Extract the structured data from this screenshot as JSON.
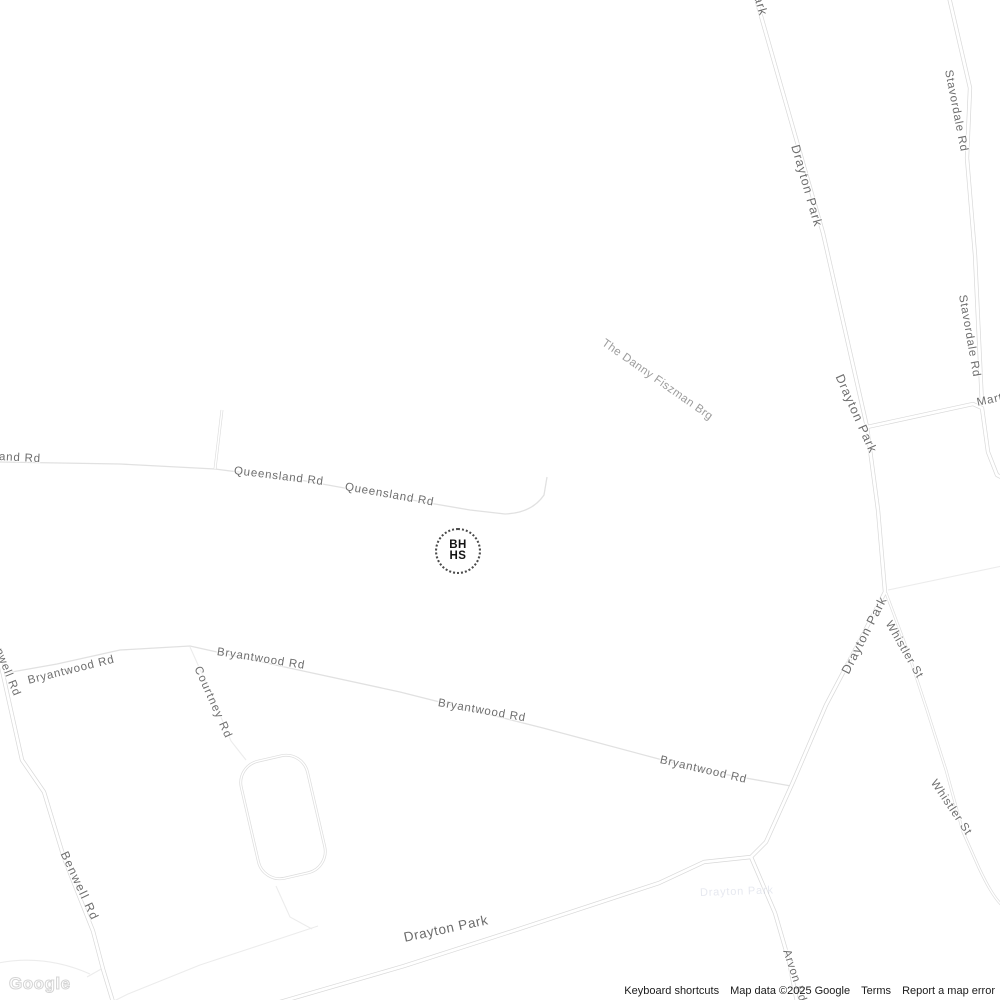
{
  "map": {
    "colors": {
      "background": "#ffffff",
      "road_casing": "#d8d8d8",
      "road_fill": "#ffffff",
      "minor_road": "#e1e1e1",
      "faint_path": "#ececec",
      "label": "#6e6e6e",
      "label_secondary": "#9c9c9c"
    },
    "labels": [
      {
        "name": "road-label-drayton-park-top",
        "text": "ark",
        "x": 758,
        "y": -4,
        "rot": 74,
        "cls": "lbl-main"
      },
      {
        "name": "road-label-drayton-park-1",
        "text": "Drayton Park",
        "x": 795,
        "y": 145,
        "rot": 74,
        "cls": "lbl-main"
      },
      {
        "name": "road-label-stavordale-rd-1",
        "text": "Stavordale Rd",
        "x": 948,
        "y": 70,
        "rot": 79
      },
      {
        "name": "road-label-stavordale-rd-2",
        "text": "Stavordale Rd",
        "x": 962,
        "y": 295,
        "rot": 80
      },
      {
        "name": "road-label-drayton-park-2",
        "text": "Drayton Park",
        "x": 839,
        "y": 375,
        "rot": 66,
        "cls": "lbl-main"
      },
      {
        "name": "road-label-martineau-rd",
        "text": "Martineau Rd",
        "x": 977,
        "y": 403,
        "rot": -12
      },
      {
        "name": "road-label-danny-fiszman-bridge",
        "text": "The Danny Fiszman Brg",
        "x": 603,
        "y": 342,
        "rot": 35,
        "cls": "lbl-bridge"
      },
      {
        "name": "road-label-queensland-rd-left",
        "text": "and Rd",
        "x": -1,
        "y": 457,
        "rot": 3
      },
      {
        "name": "road-label-queensland-rd-1",
        "text": "Queensland Rd",
        "x": 234,
        "y": 471,
        "rot": 7
      },
      {
        "name": "road-label-queensland-rd-2",
        "text": "Queensland Rd",
        "x": 345,
        "y": 487,
        "rot": 10
      },
      {
        "name": "road-label-benwell-rd-top",
        "text": "nwell Rd",
        "x": -2,
        "y": 649,
        "rot": 68
      },
      {
        "name": "road-label-bryantwood-rd-1",
        "text": "Bryantwood Rd",
        "x": 28,
        "y": 681,
        "rot": -14
      },
      {
        "name": "road-label-bryantwood-rd-2",
        "text": "Bryantwood Rd",
        "x": 217,
        "y": 652,
        "rot": 9
      },
      {
        "name": "road-label-courtney-rd",
        "text": "Courtney Rd",
        "x": 197,
        "y": 667,
        "rot": 66,
        "ls": 1.2
      },
      {
        "name": "road-label-bryantwood-rd-3",
        "text": "Bryantwood Rd",
        "x": 438,
        "y": 703,
        "rot": 10
      },
      {
        "name": "road-label-bryantwood-rd-4",
        "text": "Bryantwood Rd",
        "x": 660,
        "y": 760,
        "rot": 13
      },
      {
        "name": "road-label-drayton-park-3",
        "text": "Drayton Park",
        "x": 845,
        "y": 673,
        "rot": -63,
        "cls": "lbl-main"
      },
      {
        "name": "road-label-whistler-st-1",
        "text": "Whistler St",
        "x": 888,
        "y": 622,
        "rot": 60
      },
      {
        "name": "road-label-whistler-st-2",
        "text": "Whistler St",
        "x": 933,
        "y": 781,
        "rot": 56
      },
      {
        "name": "road-label-benwell-rd-2",
        "text": "Benwell Rd",
        "x": 64,
        "y": 852,
        "rot": 65,
        "size": 12,
        "ls": 1.4
      },
      {
        "name": "road-label-arvon-rd",
        "text": "Arvon Rd",
        "x": 786,
        "y": 950,
        "rot": 72
      },
      {
        "name": "road-label-drayton-park-main",
        "text": "Drayton Park",
        "x": 404,
        "y": 938,
        "rot": -12,
        "cls": "lbl-big"
      },
      {
        "name": "ghost-label-drayton-park",
        "text": "Drayton Park",
        "x": 700,
        "y": 893,
        "rot": -2,
        "cls": "lbl-ghost",
        "size": 11
      }
    ]
  },
  "marker": {
    "line1": "BH",
    "line2": "HS"
  },
  "attribution": {
    "logo": "Google",
    "keyboard_shortcuts": "Keyboard shortcuts",
    "map_data": "Map data ©2025 Google",
    "terms": "Terms",
    "report_error": "Report a map error"
  }
}
